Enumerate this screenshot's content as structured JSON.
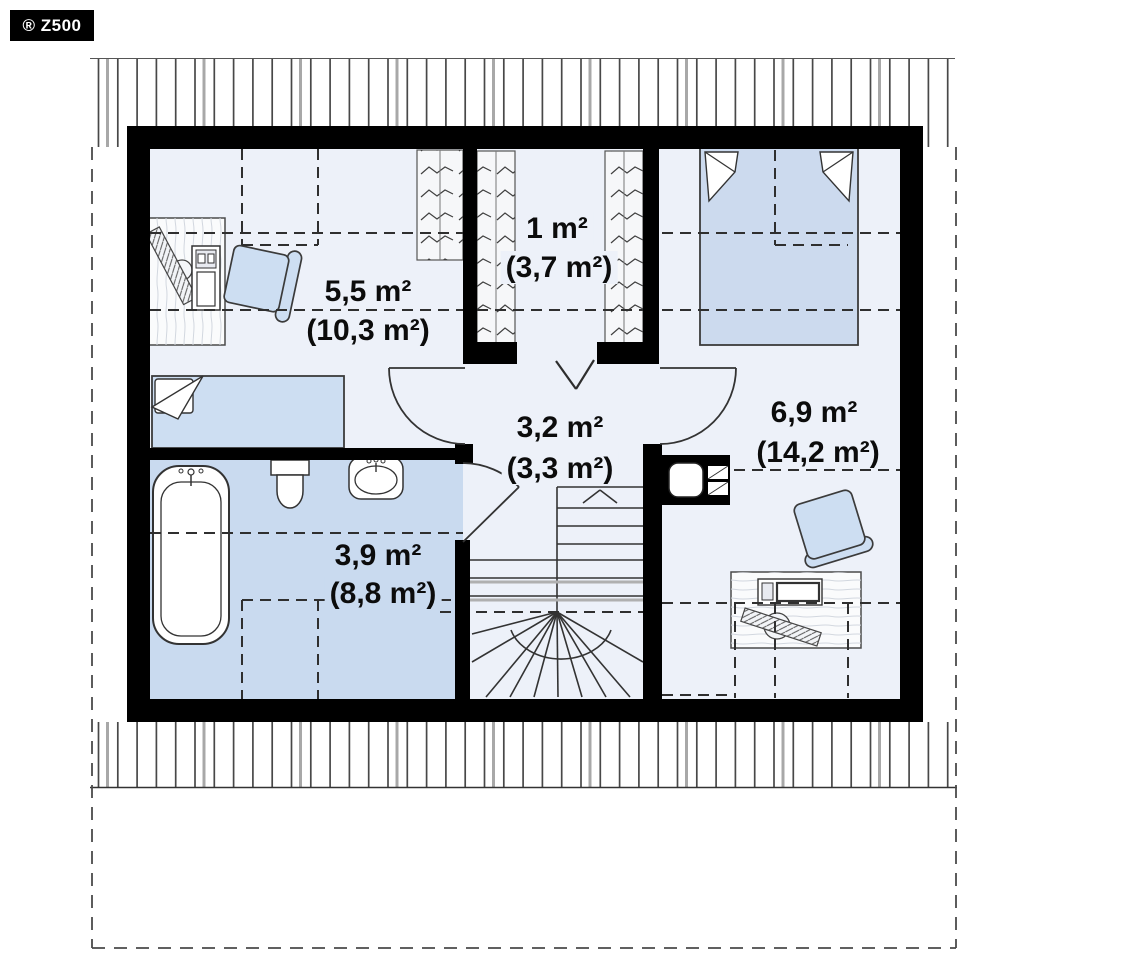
{
  "badge": {
    "label": "® Z500"
  },
  "plan": {
    "type": "attic-floor-plan",
    "rooms": [
      {
        "name": "room-upper-left",
        "area_usable": "5,5 m²",
        "area_floor": "(10,3 m²)"
      },
      {
        "name": "wardrobe",
        "area_usable": "1 m²",
        "area_floor": "(3,7 m²)"
      },
      {
        "name": "hall",
        "area_usable": "3,2 m²",
        "area_floor": "(3,3 m²)"
      },
      {
        "name": "room-right",
        "area_usable": "6,9 m²",
        "area_floor": "(14,2 m²)"
      },
      {
        "name": "bathroom",
        "area_usable": "3,9 m²",
        "area_floor": "(8,8 m²)"
      }
    ],
    "colors": {
      "wall": "#000000",
      "floor": "#edf1f9",
      "bathroom_floor": "#c9daef",
      "furniture_fill": "#cddef2",
      "line": "#333333",
      "background": "#ffffff"
    }
  }
}
